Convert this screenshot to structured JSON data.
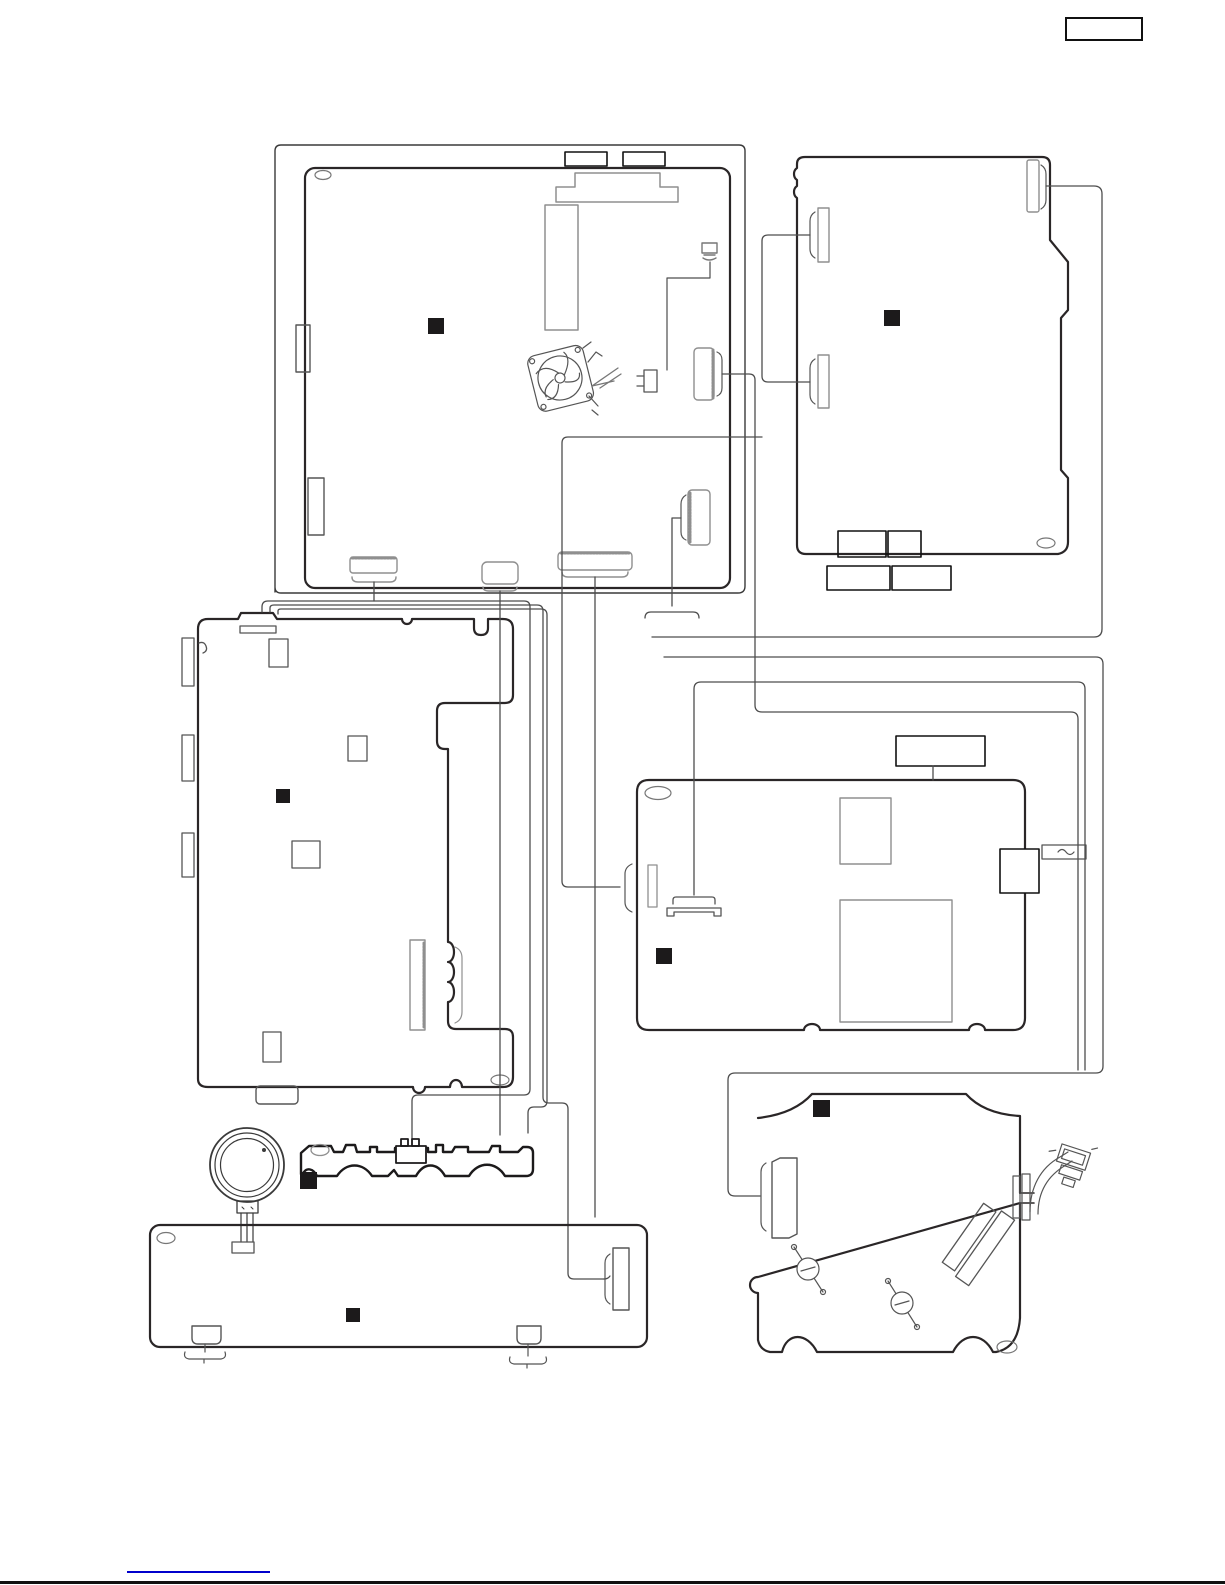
{
  "page": {
    "background": "#ffffff",
    "line_color": "#231f20",
    "board_stroke": "#2a2627",
    "connector_stroke": "#8f8f8f",
    "wire_color": "#4d4d4d",
    "marker_color": "#1c1a1b",
    "accent_link_color": "#0000cc"
  },
  "header": {
    "label_box_text": ""
  },
  "footer": {
    "link_text": "",
    "rule": true
  },
  "markers": [
    {
      "x": 428,
      "y": 318,
      "s": 16
    },
    {
      "x": 884,
      "y": 310,
      "s": 16
    },
    {
      "x": 276,
      "y": 789,
      "s": 14
    },
    {
      "x": 656,
      "y": 948,
      "s": 16
    },
    {
      "x": 813,
      "y": 1100,
      "s": 17
    },
    {
      "x": 300,
      "y": 1172,
      "s": 17
    },
    {
      "x": 346,
      "y": 1308,
      "s": 14
    }
  ]
}
